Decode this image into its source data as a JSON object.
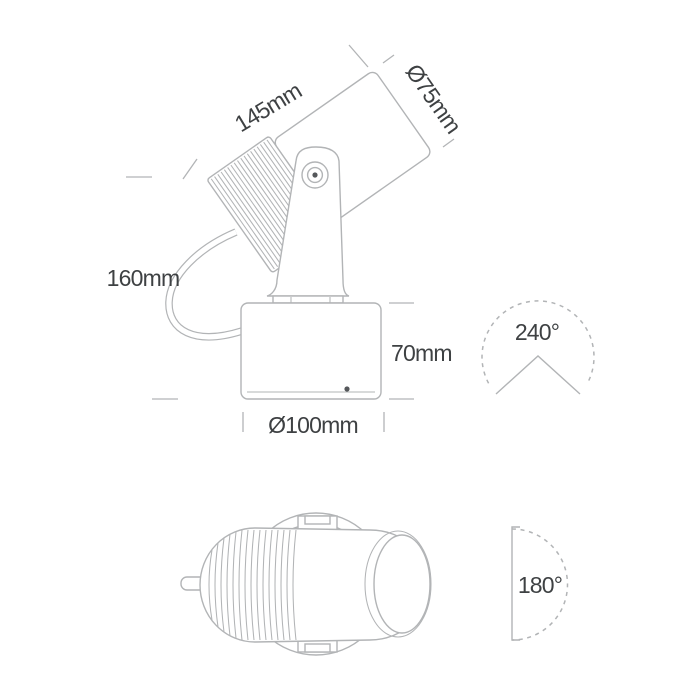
{
  "colors": {
    "background": "#ffffff",
    "line": "#b2b4b6",
    "text": "#3e4143",
    "detail": "#55585b"
  },
  "side_view": {
    "labels": {
      "head_length": "145mm",
      "head_diameter": "Ø75mm",
      "overall_height": "160mm",
      "base_height": "70mm",
      "base_diameter": "Ø100mm",
      "tilt_angle": "240°"
    }
  },
  "top_view": {
    "labels": {
      "rotation_angle": "180°"
    }
  },
  "icons": {
    "tilt_range_icon": "dashed 240-degree arc with chevron",
    "rotation_range_icon": "dashed 180-degree semicircle with bracket line"
  }
}
